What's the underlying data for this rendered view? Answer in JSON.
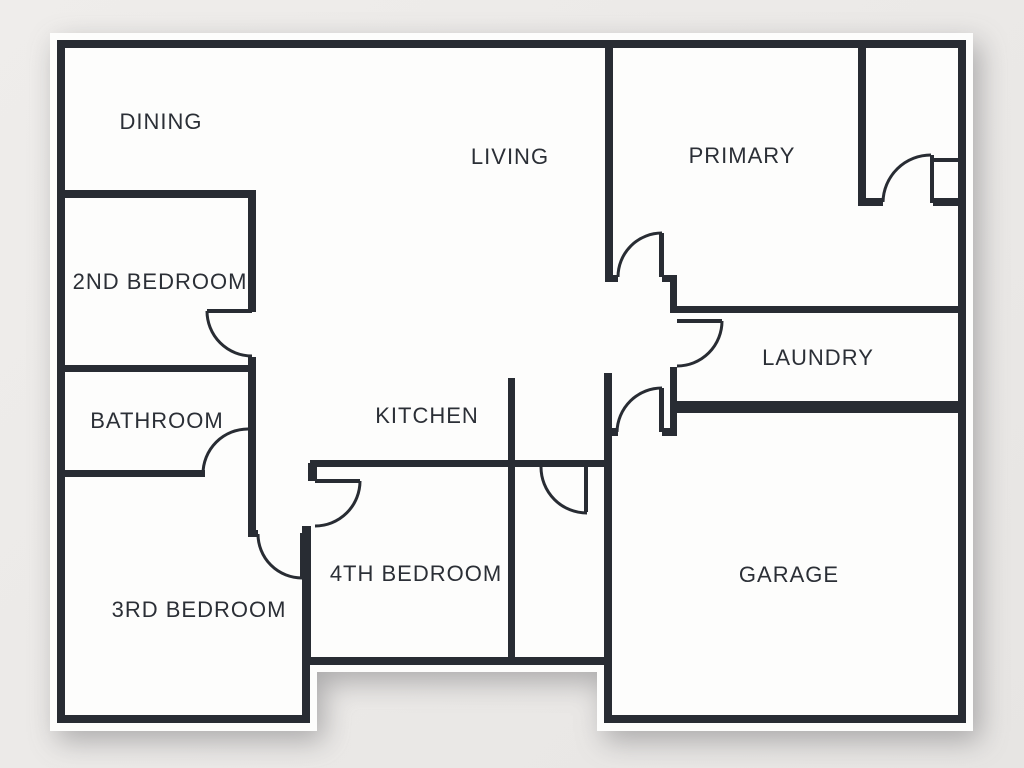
{
  "type": "floor-plan",
  "colors": {
    "background": "#ebe9e7",
    "paper": "#fdfdfc",
    "wall": "#282c33",
    "label_text": "#2b2f36"
  },
  "rooms": [
    {
      "name": "dining",
      "label": "DINING"
    },
    {
      "name": "living",
      "label": "LIVING"
    },
    {
      "name": "primary",
      "label": "PRIMARY"
    },
    {
      "name": "second-bedroom",
      "label": "2ND BEDROOM"
    },
    {
      "name": "bathroom",
      "label": "BATHROOM"
    },
    {
      "name": "kitchen",
      "label": "KITCHEN"
    },
    {
      "name": "laundry",
      "label": "LAUNDRY"
    },
    {
      "name": "third-bedroom",
      "label": "3RD BEDROOM"
    },
    {
      "name": "fourth-bedroom",
      "label": "4TH BEDROOM"
    },
    {
      "name": "garage",
      "label": "GARAGE"
    }
  ]
}
